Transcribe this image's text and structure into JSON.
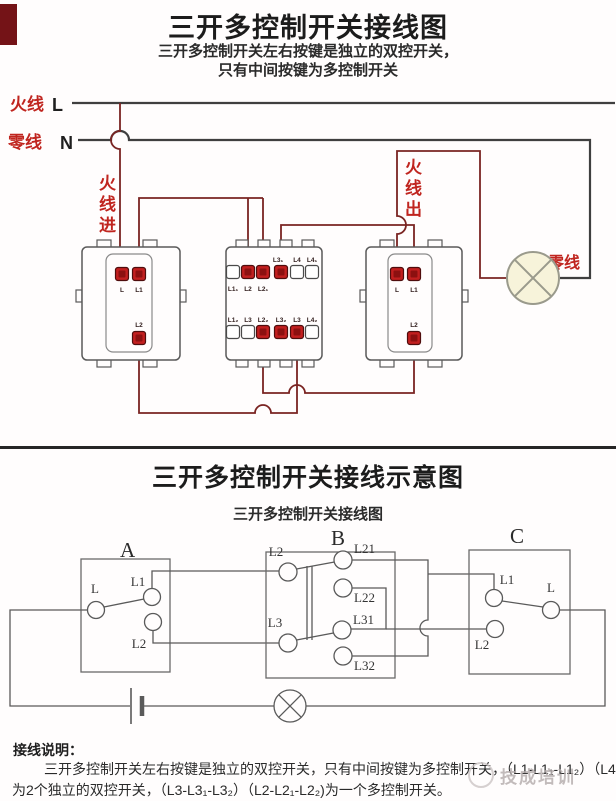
{
  "top": {
    "title": "三开多控制开关接线图",
    "subtitle_line1": "三开多控制开关左右按键是独立的双控开关，",
    "subtitle_line2": "只有中间按键为多控制开关",
    "live_label": "火线",
    "live_letter": "L",
    "neutral_label": "零线",
    "neutral_letter": "N",
    "live_in_label": "火线进",
    "live_out_label": "火线出",
    "neutral_right_label": "零线",
    "sw1": {
      "t_l": "L",
      "t_l1": "L1",
      "t_l2": "L2"
    },
    "sw2": {
      "top_labels": [
        "L1₁",
        "L2",
        "L2₁",
        "L3₁",
        "L4",
        "L4₁"
      ],
      "bottom_labels": [
        "L1₂",
        "L3",
        "L2₂",
        "L3₂",
        "L3",
        "L4₂"
      ]
    },
    "sw3": {
      "t_l": "L",
      "t_l1": "L1",
      "t_l2": "L2"
    }
  },
  "bottom": {
    "title": "三开多控制开关接线示意图",
    "subtitle": "三开多控制开关接线图",
    "switch_a": {
      "name": "A",
      "t_l": "L",
      "t_l1": "L1",
      "t_l2": "L2"
    },
    "switch_b": {
      "name": "B",
      "t_l2": "L2",
      "t_l3": "L3",
      "t_l21": "L21",
      "t_l22": "L22",
      "t_l31": "L31",
      "t_l32": "L32"
    },
    "switch_c": {
      "name": "C",
      "t_l1": "L1",
      "t_l2": "L2",
      "t_l": "L"
    },
    "note_heading": "接线说明：",
    "note_line1": "三开多控制开关左右按键是独立的双控开关，只有中间按键为多控制开关，（L1-L1₁-L1₂）（L4-L4₁-L4₂）",
    "note_line2": "为2个独立的双控开关，（L3-L3₁-L3₂）（L2-L2₁-L2₂)为一个多控制开关。"
  },
  "watermark": "技成培训",
  "colors": {
    "accent_red": "#c0251f",
    "wire_maroon": "#7a2422",
    "terminal_red": "#c21f1f"
  }
}
